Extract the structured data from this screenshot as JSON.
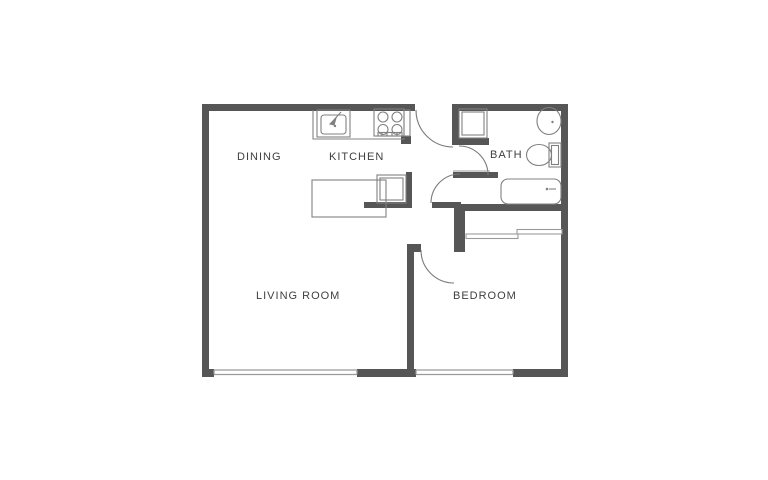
{
  "floor_plan": {
    "rooms": {
      "dining": "DINING",
      "kitchen": "KITCHEN",
      "bath": "BATH",
      "living_room": "LIVING ROOM",
      "bedroom": "BEDROOM"
    },
    "colors": {
      "wall": "#565656",
      "line": "#808080",
      "lightline": "#9a9a9a",
      "text": "#3f3f3f",
      "background": "#ffffff"
    }
  }
}
